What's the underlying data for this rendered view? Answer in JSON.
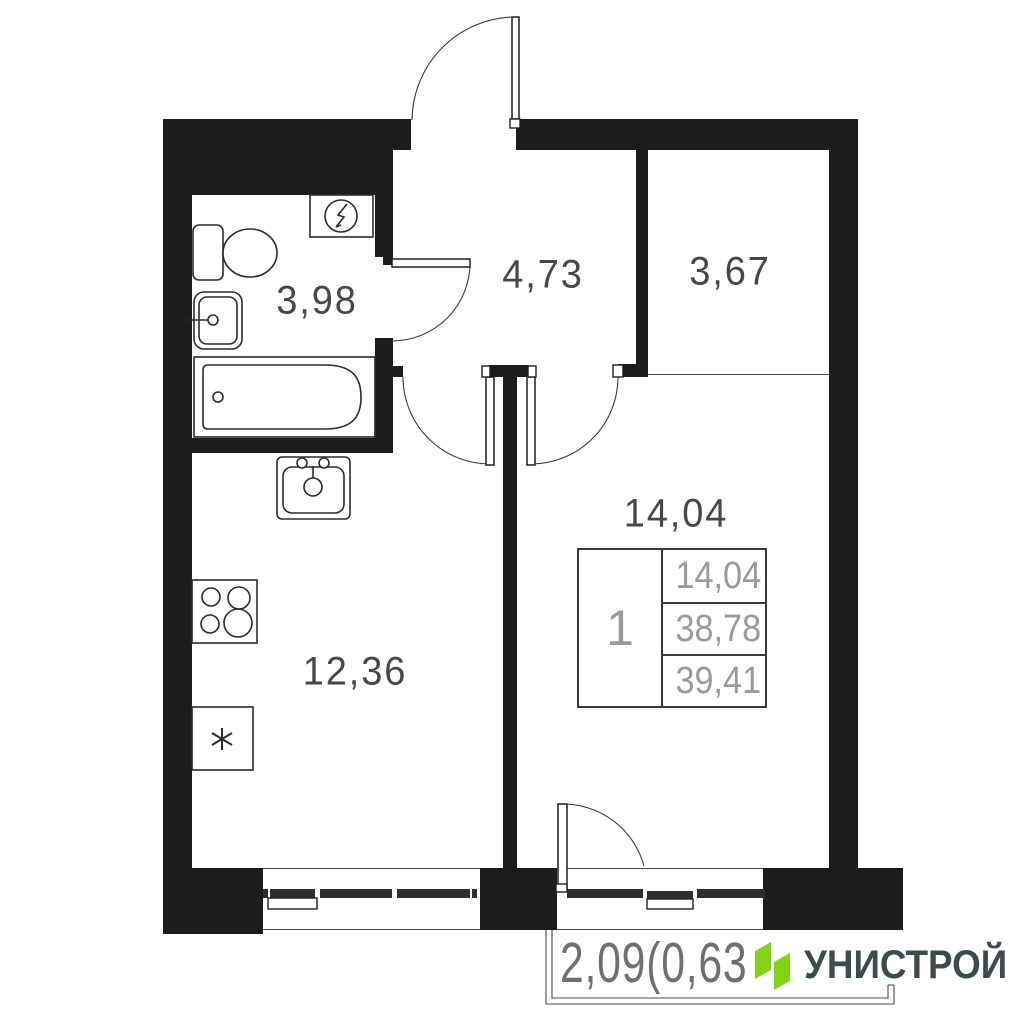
{
  "plan": {
    "rooms": [
      {
        "id": "bathroom",
        "area": "3,98"
      },
      {
        "id": "hallway",
        "area": "4,73"
      },
      {
        "id": "storage",
        "area": "3,67"
      },
      {
        "id": "kitchen-living",
        "area": "12,36"
      },
      {
        "id": "bedroom",
        "area": "14,04"
      }
    ],
    "stamp": {
      "rooms_count": "1",
      "rows": [
        "14,04",
        "38,78",
        "39,41"
      ]
    },
    "balcony_dimension": "2,09(0,63",
    "fixtures": [
      "toilet",
      "washbasin",
      "bathtub",
      "electrical-panel",
      "kitchen-sink",
      "stove",
      "fridge"
    ]
  },
  "logo": {
    "brand": "УНИСТРОЙ"
  },
  "colors": {
    "wall": "#1c1c1c",
    "label": "#474747",
    "stamp_text": "#9a9a9a",
    "dimension_text": "#6f6f6f",
    "logo_green": "#82d318",
    "logo_text": "#3b4c4c"
  }
}
